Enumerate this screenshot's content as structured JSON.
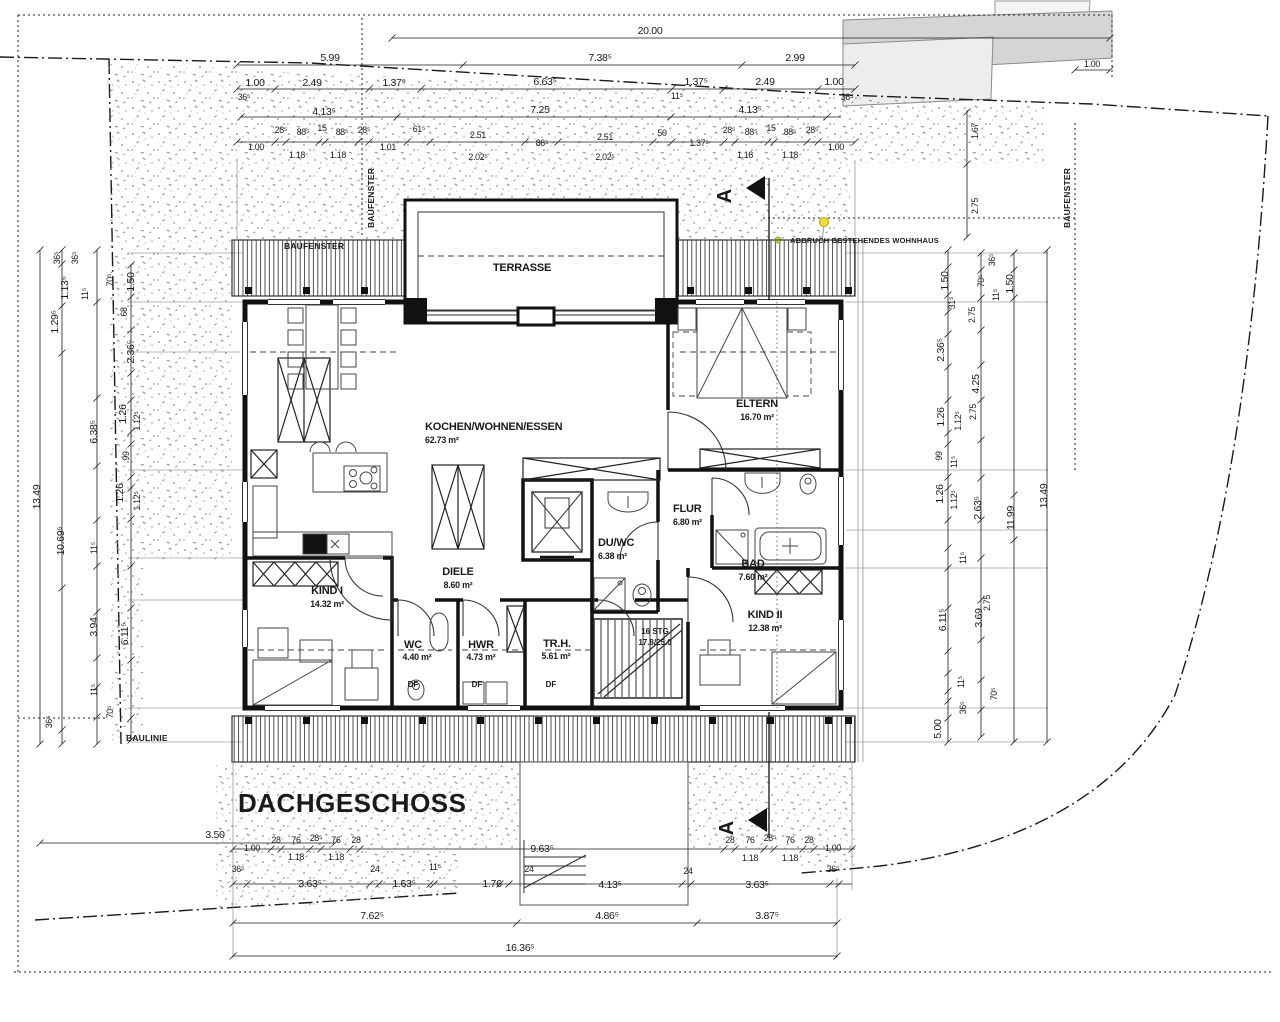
{
  "drawing": {
    "title": "DACHGESCHOSS",
    "section_marker": "A",
    "scale_total_width": "16.36⁵",
    "boundary_labels": {
      "baulinie": "BAULINIE",
      "baufenster": "BAUFENSTER",
      "abbruch": "ABBRUCH BESTEHENDES WOHNHAUS"
    },
    "rooms": {
      "terrasse": {
        "name": "TERRASSE"
      },
      "kochen": {
        "name": "KOCHEN/WOHNEN/ESSEN",
        "area": "62.73 m²"
      },
      "eltern": {
        "name": "ELTERN",
        "area": "16.70 m²"
      },
      "bad": {
        "name": "BAD",
        "area": "7.60 m²"
      },
      "flur": {
        "name": "FLUR",
        "area": "6.80 m²"
      },
      "duwc": {
        "name": "DU/WC",
        "area": "6.38 m²"
      },
      "diele": {
        "name": "DIELE",
        "area": "8.60 m²"
      },
      "kind1": {
        "name": "KIND I",
        "area": "14.32 m²"
      },
      "kind2": {
        "name": "KIND II",
        "area": "12.38 m²"
      },
      "wc": {
        "name": "WC",
        "area": "4.40 m²"
      },
      "hwr": {
        "name": "HWR",
        "area": "4.73 m²"
      },
      "trh": {
        "name": "TR.H.",
        "area": "5.61 m²"
      }
    },
    "stairs": {
      "line1": "16 STG",
      "line2": "17.8/25.0"
    },
    "df_label": "DF",
    "colors": {
      "paper": "#ffffff",
      "ink": "#1a1a1a",
      "stipple_dot": "#8f8f8f",
      "neighbor_building_dark": "#d5d5d5",
      "neighbor_building_light": "#ededed",
      "marker_yellow": "#f2e03a",
      "marker_green": "#cbd246"
    },
    "dim_labels": [
      [
        650,
        34,
        "20.00"
      ],
      [
        330,
        61,
        "5.99"
      ],
      [
        600,
        61,
        "7.38⁵"
      ],
      [
        795,
        61,
        "2.99"
      ],
      [
        255,
        86,
        "1.00"
      ],
      [
        312,
        86,
        "2.49"
      ],
      [
        394,
        86,
        "1.37⁵"
      ],
      [
        545,
        85,
        "6.63⁵"
      ],
      [
        696,
        85,
        "1.37⁵"
      ],
      [
        765,
        85,
        "2.49"
      ],
      [
        834,
        85,
        "1.00"
      ],
      [
        244,
        100,
        "36⁵",
        "s"
      ],
      [
        677,
        99,
        "11⁵",
        "s"
      ],
      [
        847,
        100,
        "36⁵",
        "s"
      ],
      [
        324,
        115,
        "4.13⁵"
      ],
      [
        540,
        113,
        "7.25"
      ],
      [
        750,
        113,
        "4.13⁵"
      ],
      [
        256,
        150,
        "1.00",
        "s"
      ],
      [
        281,
        133,
        "28⁵",
        "s"
      ],
      [
        303,
        135,
        "88⁵",
        "s"
      ],
      [
        322,
        131,
        "15",
        "s"
      ],
      [
        342,
        135,
        "88⁵",
        "s"
      ],
      [
        364,
        133,
        "28⁵",
        "s"
      ],
      [
        297,
        158,
        "1.18",
        "s"
      ],
      [
        338,
        158,
        "1.18",
        "s"
      ],
      [
        388,
        150,
        "1.01",
        "s"
      ],
      [
        419,
        132,
        "61⁵",
        "s"
      ],
      [
        478,
        138,
        "2.51",
        "s"
      ],
      [
        478,
        160,
        "2.02⁵",
        "s"
      ],
      [
        542,
        146,
        "86⁵",
        "s"
      ],
      [
        605,
        140,
        "2.51",
        "s"
      ],
      [
        605,
        160,
        "2.02⁵",
        "s"
      ],
      [
        662,
        136,
        "50",
        "s"
      ],
      [
        699,
        146,
        "1.37⁵",
        "s"
      ],
      [
        729,
        133,
        "28⁵",
        "s"
      ],
      [
        751,
        135,
        "88⁵",
        "s"
      ],
      [
        771,
        131,
        "15",
        "s"
      ],
      [
        790,
        135,
        "88⁵",
        "s"
      ],
      [
        812,
        133,
        "28⁵",
        "s"
      ],
      [
        745,
        158,
        "1.18",
        "s"
      ],
      [
        790,
        158,
        "1.18",
        "s"
      ],
      [
        836,
        150,
        "1.00",
        "s"
      ],
      [
        1092,
        67,
        "1.00",
        "s"
      ],
      [
        978,
        131,
        "1.67",
        "rs"
      ],
      [
        978,
        206,
        "2.75",
        "rs"
      ],
      [
        40,
        497,
        "13.49",
        "r"
      ],
      [
        60,
        258,
        "36⁵",
        "rs"
      ],
      [
        78,
        258,
        "36⁵",
        "rs"
      ],
      [
        68,
        288,
        "1.13⁵",
        "r"
      ],
      [
        88,
        294,
        "11⁵",
        "rs"
      ],
      [
        58,
        322,
        "1.29⁵",
        "r"
      ],
      [
        64,
        541,
        "10.69⁵",
        "r"
      ],
      [
        97,
        432,
        "6.38⁵",
        "r"
      ],
      [
        97,
        548,
        "11⁵",
        "rs"
      ],
      [
        97,
        627,
        "3.94",
        "r"
      ],
      [
        97,
        690,
        "11⁵",
        "rs"
      ],
      [
        52,
        722,
        "36⁵",
        "rs"
      ],
      [
        113,
        280,
        "70⁵",
        "rs"
      ],
      [
        134,
        282,
        "1.50",
        "r"
      ],
      [
        127,
        312,
        "68",
        "rs"
      ],
      [
        134,
        352,
        "2.36⁵",
        "r"
      ],
      [
        126,
        414,
        "1.26",
        "r"
      ],
      [
        140,
        421,
        "1.12⁵",
        "rs"
      ],
      [
        129,
        456,
        "99",
        "rs"
      ],
      [
        123,
        493,
        "1.26",
        "r"
      ],
      [
        140,
        501,
        "1.12⁵",
        "rs"
      ],
      [
        128,
        634,
        "6.11⁵",
        "r"
      ],
      [
        113,
        712,
        "70⁵",
        "rs"
      ],
      [
        948,
        281,
        "1.50",
        "r"
      ],
      [
        984,
        281,
        "70⁵",
        "rs"
      ],
      [
        955,
        303,
        "31⁵",
        "rs"
      ],
      [
        999,
        295,
        "11⁵",
        "rs"
      ],
      [
        1013,
        284,
        "1.50",
        "r"
      ],
      [
        995,
        260,
        "36⁵",
        "rs"
      ],
      [
        975,
        315,
        "2.75",
        "rs"
      ],
      [
        944,
        350,
        "2.36⁵",
        "r"
      ],
      [
        979,
        384,
        "4.25",
        "r"
      ],
      [
        976,
        412,
        "2.75",
        "rs"
      ],
      [
        944,
        417,
        "1.26",
        "r"
      ],
      [
        961,
        421,
        "1.12⁵",
        "rs"
      ],
      [
        942,
        456,
        "99",
        "rs"
      ],
      [
        957,
        462,
        "11⁵",
        "rs"
      ],
      [
        943,
        494,
        "1.26",
        "r"
      ],
      [
        957,
        500,
        "1.12⁵",
        "rs"
      ],
      [
        981,
        508,
        "2.63⁵",
        "r"
      ],
      [
        1014,
        518,
        "11.99",
        "r"
      ],
      [
        1047,
        496,
        "13.49",
        "r"
      ],
      [
        966,
        558,
        "11⁵",
        "rs"
      ],
      [
        990,
        603,
        "2.75",
        "rs"
      ],
      [
        982,
        618,
        "3.69",
        "r"
      ],
      [
        946,
        620,
        "6.11⁵",
        "r"
      ],
      [
        964,
        682,
        "11⁵",
        "rs"
      ],
      [
        997,
        694,
        "70⁵",
        "rs"
      ],
      [
        966,
        708,
        "36⁵",
        "rs"
      ],
      [
        941,
        729,
        "5.00",
        "r"
      ],
      [
        215,
        838,
        "3.50"
      ],
      [
        252,
        851,
        "1.00",
        "s"
      ],
      [
        276,
        843,
        "28",
        "s"
      ],
      [
        296,
        843,
        "76",
        "s"
      ],
      [
        316,
        841,
        "28⁵",
        "s"
      ],
      [
        336,
        843,
        "76",
        "s"
      ],
      [
        356,
        843,
        "28",
        "s"
      ],
      [
        296,
        860,
        "1.18",
        "s"
      ],
      [
        336,
        860,
        "1.18",
        "s"
      ],
      [
        238,
        872,
        "36⁵",
        "s"
      ],
      [
        542,
        852,
        "9.63⁵"
      ],
      [
        730,
        843,
        "28",
        "s"
      ],
      [
        750,
        843,
        "76",
        "s"
      ],
      [
        770,
        841,
        "28⁵",
        "s"
      ],
      [
        790,
        843,
        "76",
        "s"
      ],
      [
        809,
        843,
        "28",
        "s"
      ],
      [
        750,
        861,
        "1.18",
        "s"
      ],
      [
        790,
        861,
        "1.18",
        "s"
      ],
      [
        833,
        851,
        "1.00",
        "s"
      ],
      [
        310,
        887,
        "3.63⁵"
      ],
      [
        375,
        872,
        "24",
        "s"
      ],
      [
        404,
        887,
        "1.63⁵"
      ],
      [
        435,
        870,
        "11⁵",
        "s"
      ],
      [
        492,
        887,
        "1.76"
      ],
      [
        529,
        872,
        "24",
        "s"
      ],
      [
        610,
        888,
        "4.13⁵"
      ],
      [
        688,
        874,
        "24",
        "s"
      ],
      [
        757,
        888,
        "3.63⁵"
      ],
      [
        833,
        872,
        "36⁵",
        "s"
      ],
      [
        372,
        919,
        "7.62⁵"
      ],
      [
        607,
        919,
        "4.86⁵"
      ],
      [
        767,
        919,
        "3.87⁵"
      ],
      [
        520,
        951,
        "16.36⁵"
      ]
    ]
  }
}
